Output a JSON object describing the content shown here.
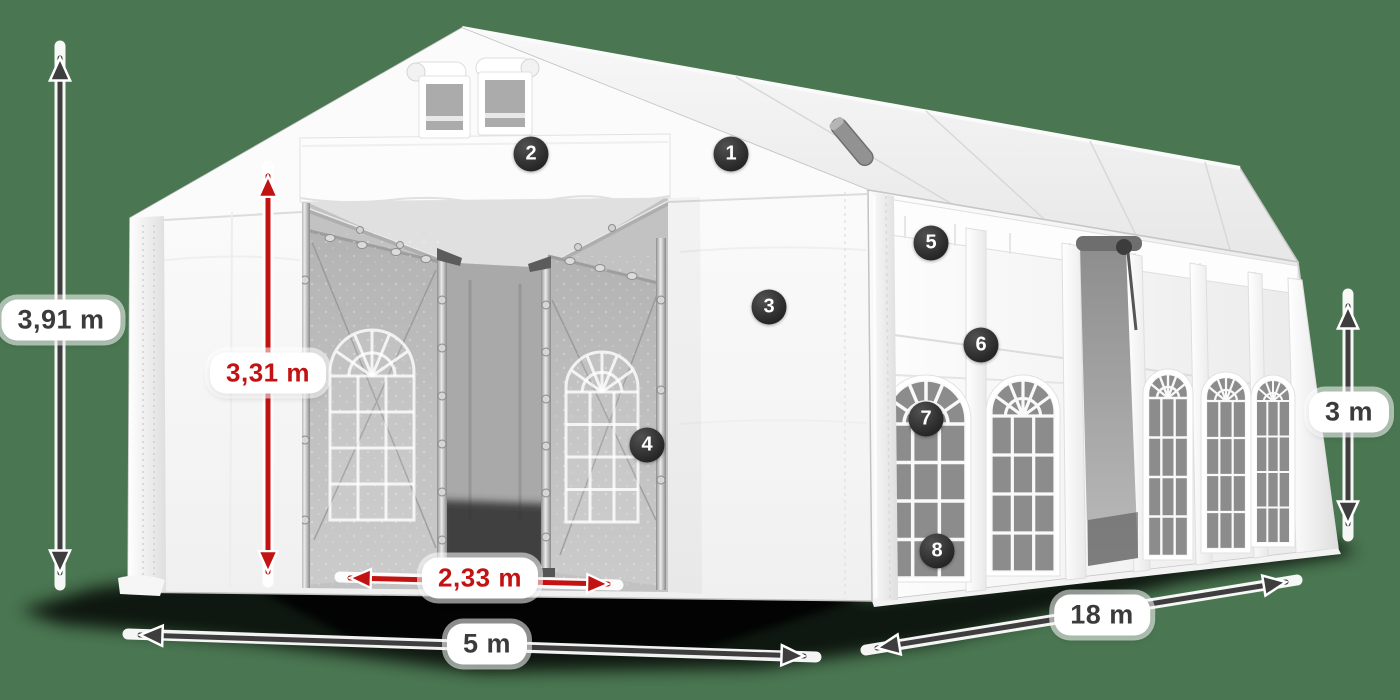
{
  "scene": {
    "background_color": "#4a7651"
  },
  "dimension_labels": {
    "total_height": "3,91 m",
    "inner_height": "3,31 m",
    "entrance_width": "2,33 m",
    "front_width": "5 m",
    "side_length": "18 m",
    "wall_height": "3 m"
  },
  "part_badges": [
    "1",
    "2",
    "3",
    "4",
    "5",
    "6",
    "7",
    "8"
  ],
  "colors": {
    "background": "#4a7651",
    "dimension_arrow_red": "#c31212",
    "dimension_arrow_gray": "#3e3e3e",
    "label_pill_background": "#ffffff",
    "label_text_dark": "#3b3b3b",
    "badge_background": "#2b2b2b",
    "badge_text": "#ffffff",
    "tent_fabric": "#ffffff"
  }
}
